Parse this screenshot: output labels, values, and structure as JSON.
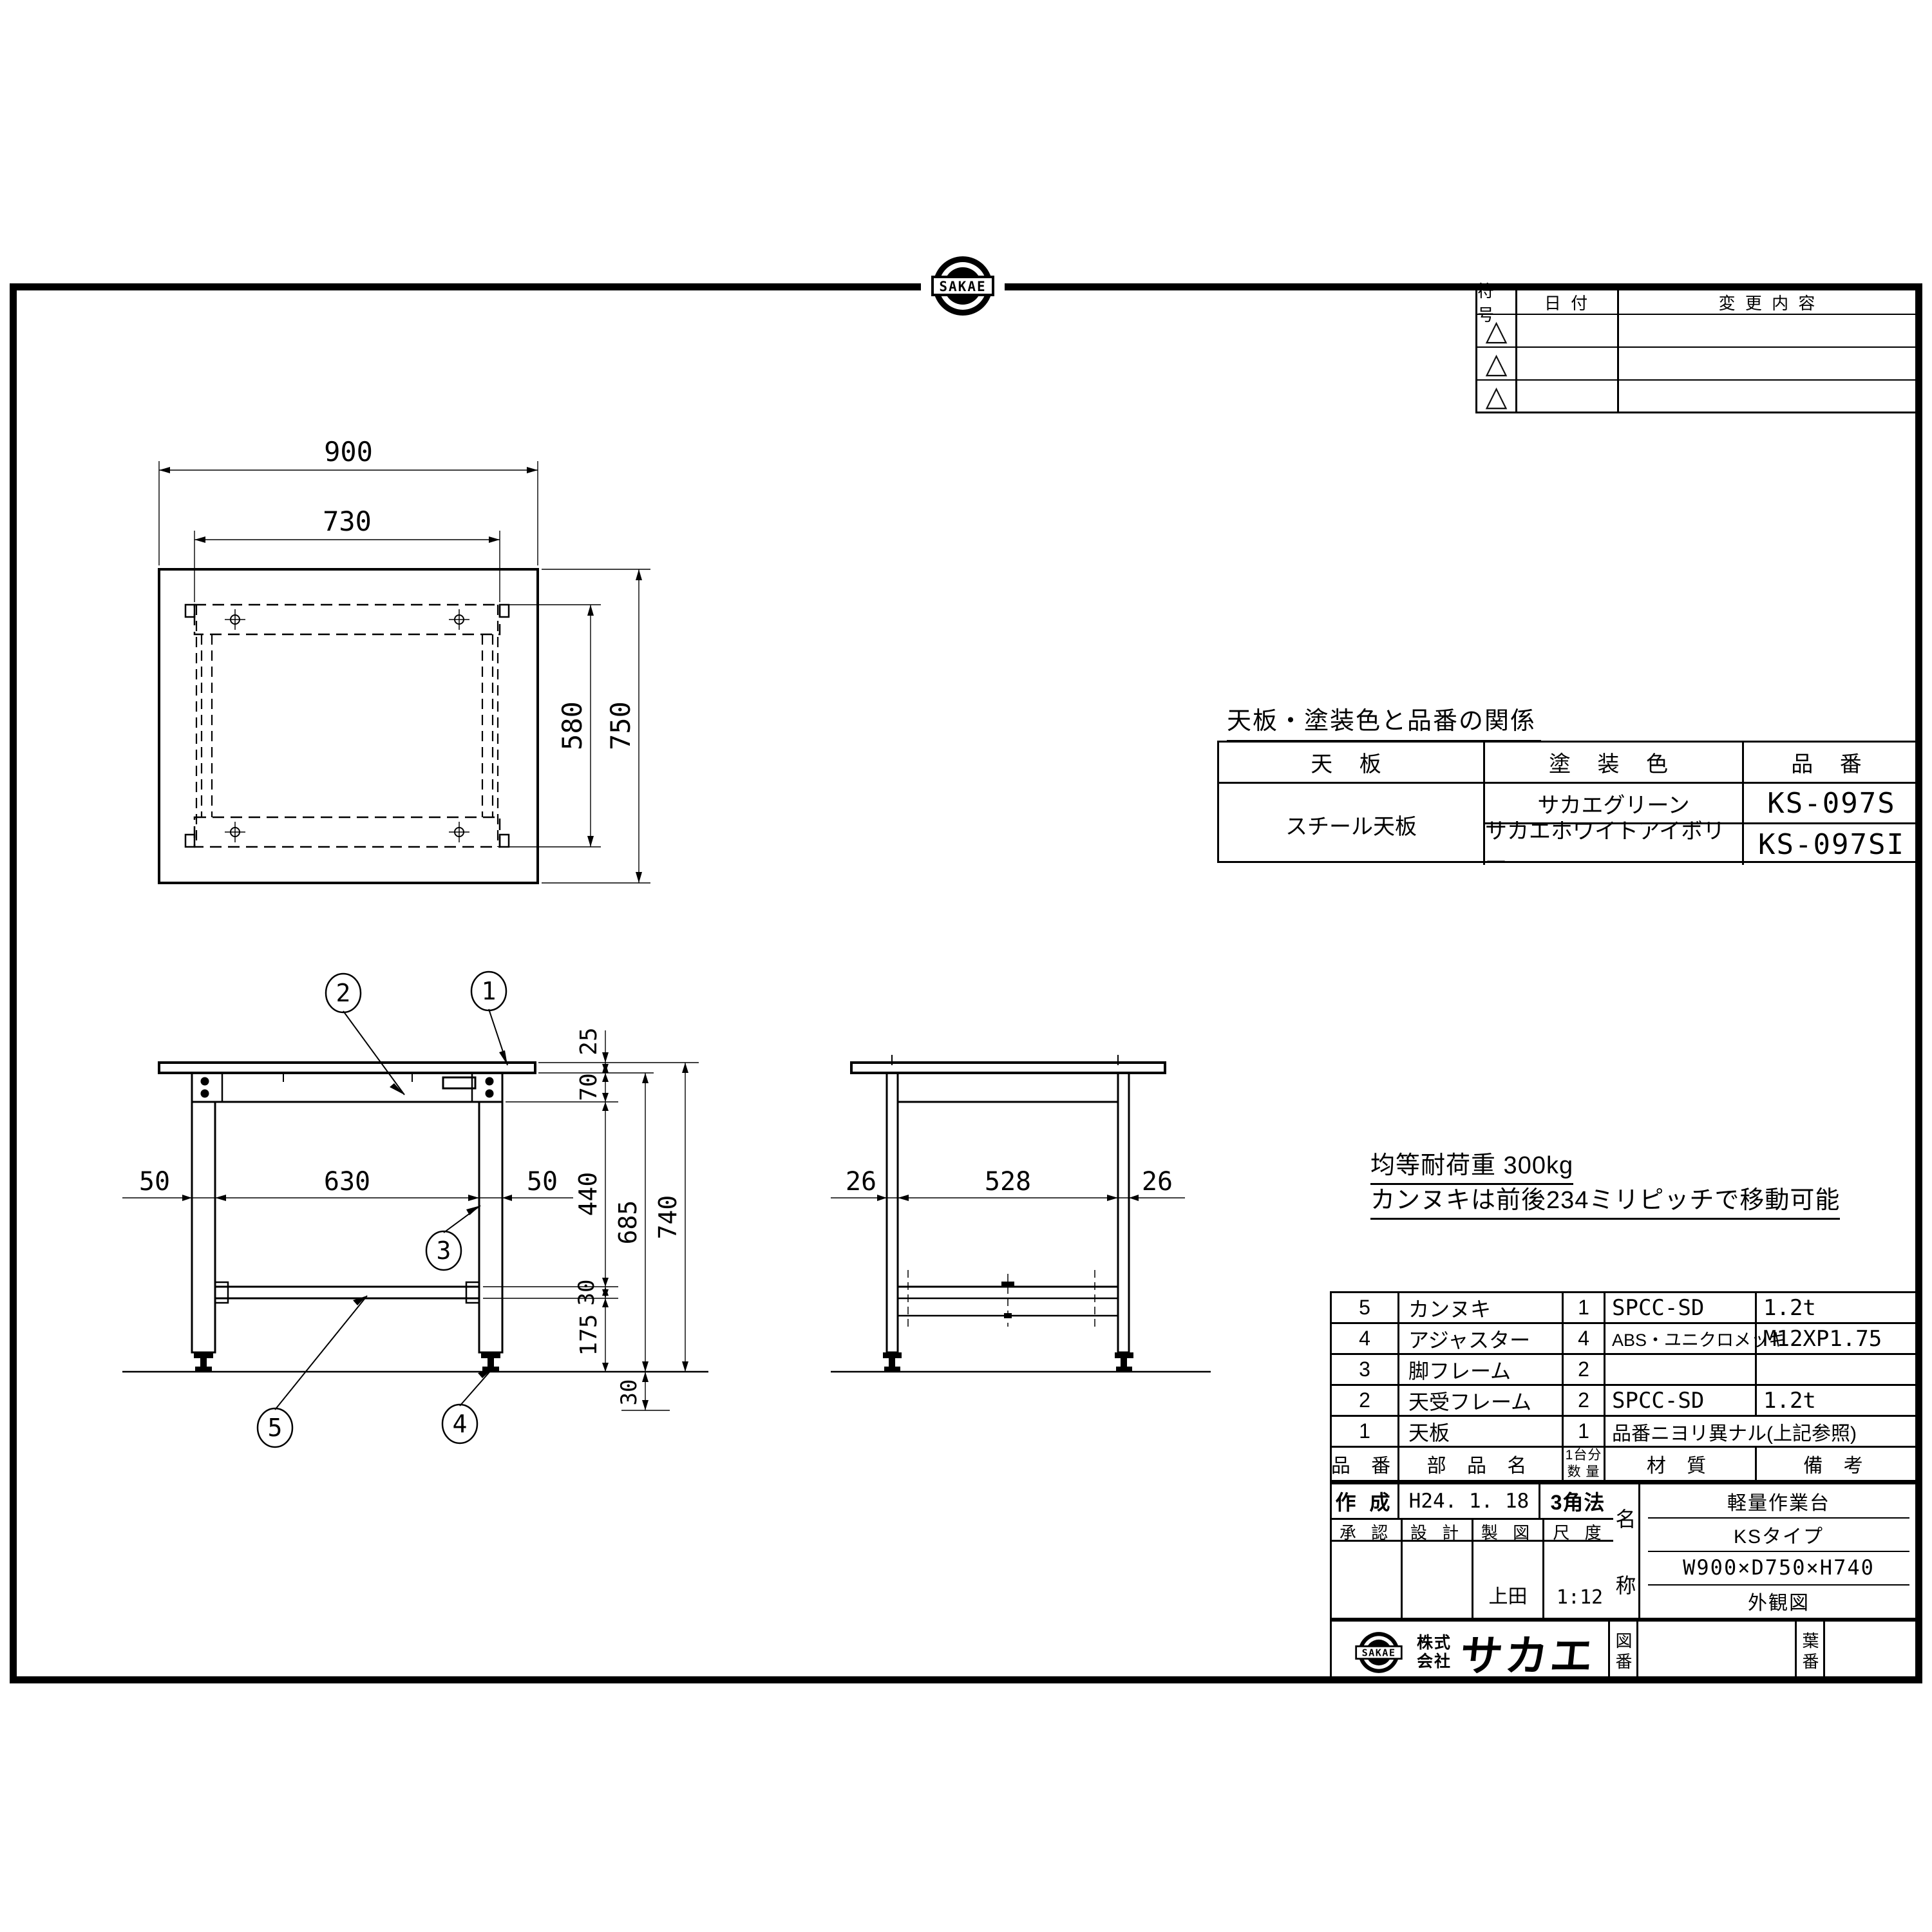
{
  "revision_table": {
    "headers": [
      "符号",
      "日  付",
      "変 更 内 容"
    ],
    "symbol": "△"
  },
  "paint_table": {
    "title": "天板・塗装色と品番の関係",
    "headers": [
      "天  板",
      "塗 装 色",
      "品  番"
    ],
    "top_board": "スチール天板",
    "rows": [
      {
        "color": "サカエグリーン",
        "part_no": "KS-097S"
      },
      {
        "color": "サカエホワイトアイボリー",
        "part_no": "KS-097SI"
      }
    ]
  },
  "notes": {
    "line1": "均等耐荷重  300kg",
    "line2": "カンヌキは前後234ミリピッチで移動可能"
  },
  "parts_table": {
    "headers": {
      "no": "品 番",
      "name": "部 品 名",
      "qty1": "1台分",
      "qty2": "数 量",
      "material": "材  質",
      "remarks": "備  考"
    },
    "rows": [
      {
        "no": "5",
        "name": "カンヌキ",
        "qty": "1",
        "material": "SPCC-SD",
        "remarks": "1.2t"
      },
      {
        "no": "4",
        "name": "アジャスター",
        "qty": "4",
        "material": "ABS・ユニクロメッキ",
        "remarks": "M12XP1.75"
      },
      {
        "no": "3",
        "name": "脚フレーム",
        "qty": "2",
        "material": "",
        "remarks": ""
      },
      {
        "no": "2",
        "name": "天受フレーム",
        "qty": "2",
        "material": "SPCC-SD",
        "remarks": "1.2t"
      },
      {
        "no": "1",
        "name": "天板",
        "qty": "1",
        "material_merged": "品番ニヨリ異ナル(上記参照)"
      }
    ]
  },
  "title_block": {
    "created_label": "作 成",
    "created_date": "H24. 1. 18",
    "projection": "3角法",
    "approve_label": "承 認",
    "design_label": "設 計",
    "draft_label": "製 図",
    "scale_label": "尺 度",
    "drafter": "上田",
    "scale": "1:12",
    "name_label_top": "名",
    "name_label_bottom": "称",
    "product_lines": [
      "軽量作業台",
      "KSタイプ",
      "W900×D750×H740",
      "外観図"
    ],
    "company_prefix": "株式会社",
    "company_prefix_1": "株式",
    "company_prefix_2": "会社",
    "company_name": "サカエ",
    "logo_text": "SAKAE",
    "dwg_no_label": "図番",
    "sheet_no_label": "葉番"
  },
  "dims": {
    "top": {
      "width": "900",
      "frame_width": "730",
      "depth": "750",
      "frame_depth": "580"
    },
    "front": {
      "overhang_left": "50",
      "leg_span": "630",
      "overhang_right": "50",
      "top_thickness": "25",
      "apron_height": "70",
      "mid_height": "440",
      "bar_height": "30",
      "lower_height": "175",
      "underside_height": "685",
      "total_height": "740",
      "adjust_range": "30"
    },
    "side": {
      "left": "26",
      "span": "528",
      "right": "26"
    }
  },
  "balloons": [
    "1",
    "2",
    "3",
    "4",
    "5"
  ]
}
